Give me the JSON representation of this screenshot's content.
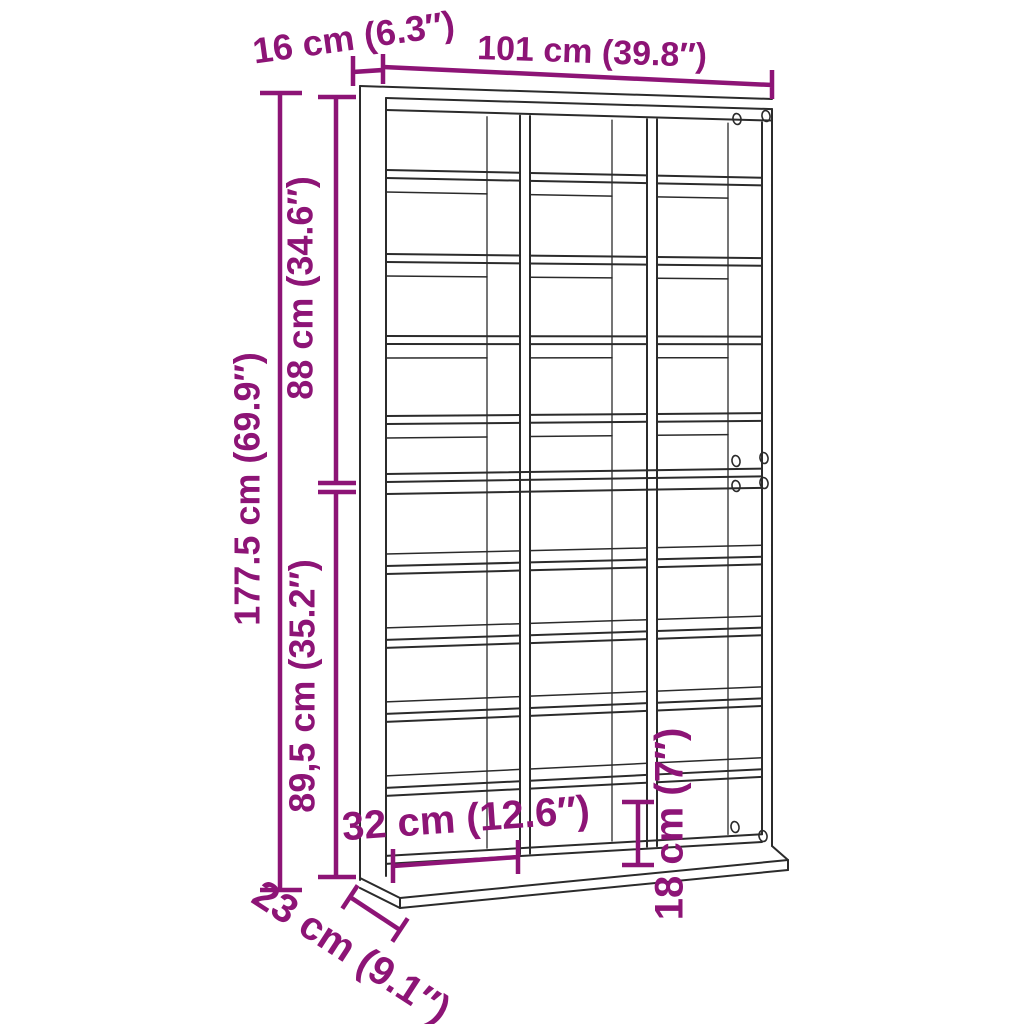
{
  "figure": {
    "kind": "furniture-dimension-diagram",
    "subject": "storage shelf with 3 columns and 10 compartment rows"
  },
  "colors": {
    "dimension": "#8d1476",
    "line_art": "#2b2b2b",
    "background": "#ffffff"
  },
  "dimensions": {
    "width": {
      "label": "101 cm (39.8″)"
    },
    "depth_top": {
      "label": "16 cm (6.3″)"
    },
    "total_height": {
      "label": "177.5 cm (69.9″)"
    },
    "upper_section_height": {
      "label": "88 cm (34.6″)"
    },
    "lower_section_height": {
      "label": "89,5 cm (35.2″)"
    },
    "compartment_width": {
      "label": "32 cm (12.6″)"
    },
    "bottom_compartment_height": {
      "label": "18 cm (7″)"
    },
    "base_depth": {
      "label": "23 cm (9.1″)"
    }
  }
}
